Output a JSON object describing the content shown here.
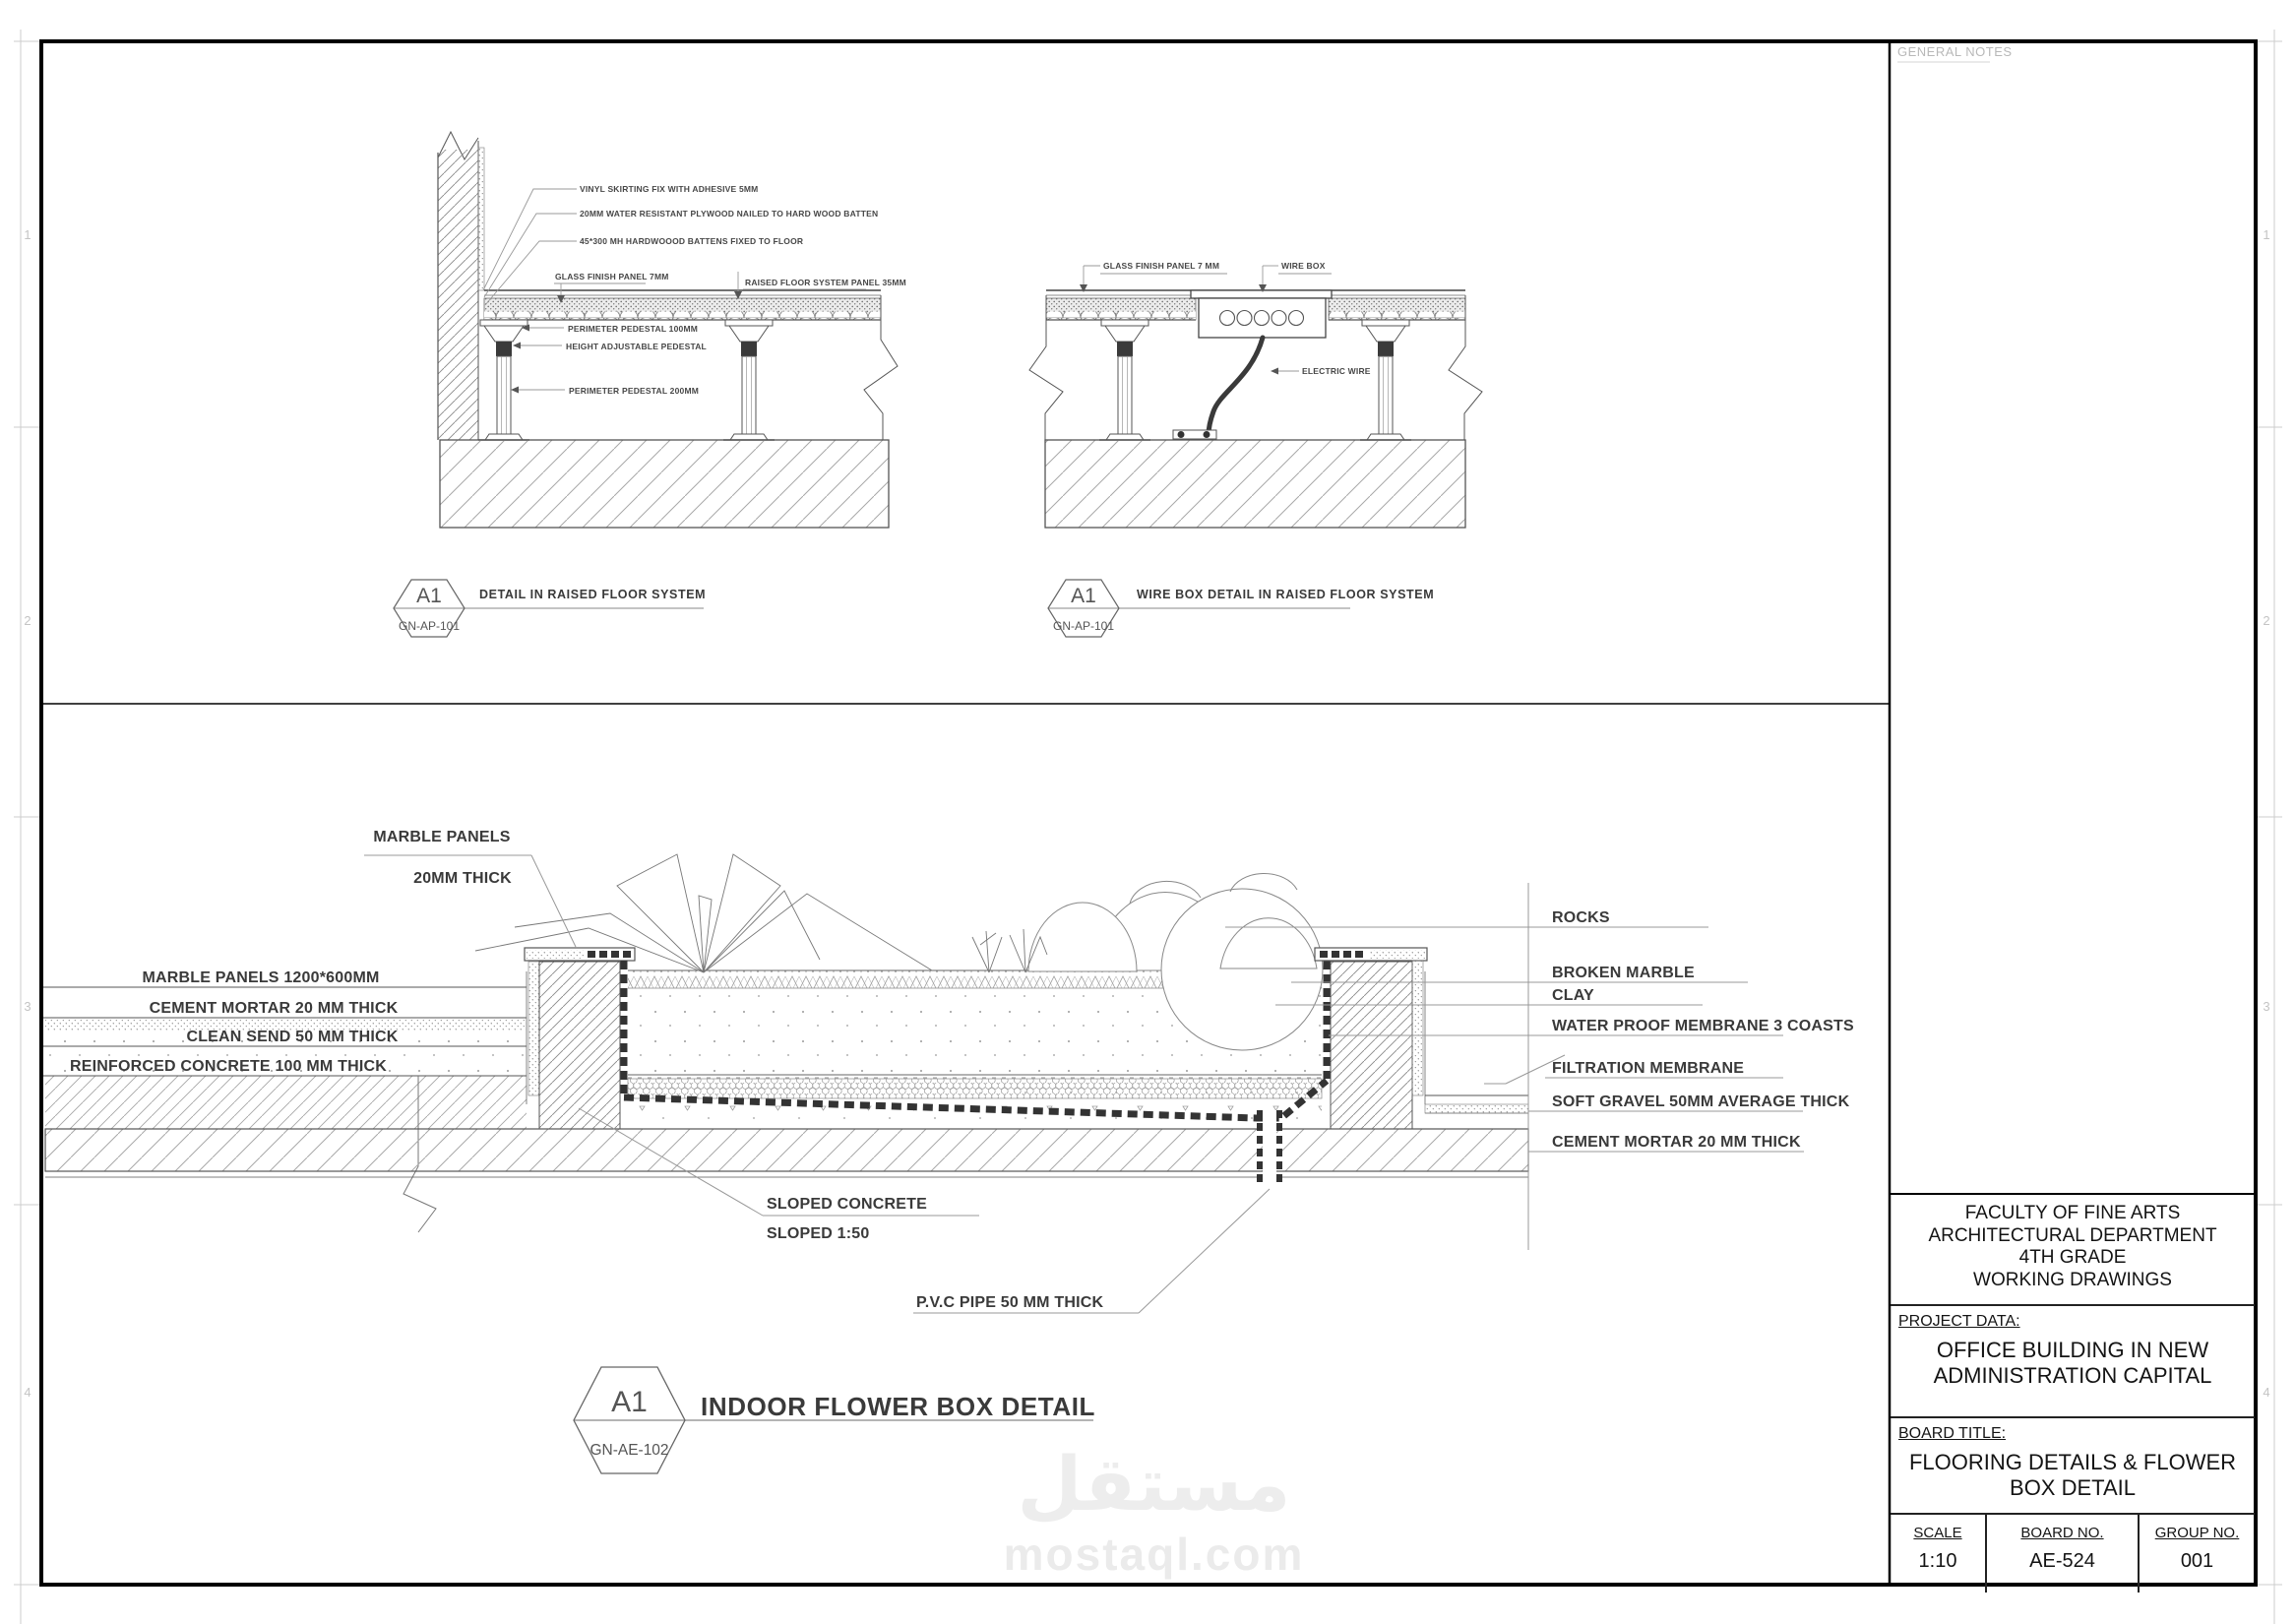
{
  "sheet": {
    "general_notes_label": "GENERAL NOTES",
    "zones": [
      "1",
      "2",
      "3",
      "4"
    ],
    "watermark": {
      "arabic": "مستقل",
      "latin": "mostaql.com"
    }
  },
  "title_block": {
    "institution": [
      "FACULTY OF FINE ARTS",
      "ARCHITECTURAL DEPARTMENT",
      "4TH GRADE",
      "WORKING DRAWINGS"
    ],
    "project_data_label": "PROJECT DATA:",
    "project_name": [
      "OFFICE BUILDING IN NEW",
      "ADMINISTRATION CAPITAL"
    ],
    "board_title_label": "BOARD TITLE:",
    "board_title": [
      "FLOORING DETAILS & FLOWER",
      "BOX DETAIL"
    ],
    "scale_label": "SCALE",
    "scale_value": "1:10",
    "board_no_label": "BOARD NO.",
    "board_no_value": "AE-524",
    "group_no_label": "GROUP NO.",
    "group_no_value": "001"
  },
  "detail_raised_floor": {
    "tag": "A1",
    "code": "GN-AP-101",
    "title": "DETAIL IN RAISED FLOOR SYSTEM",
    "labels": {
      "vinyl_skirting": "VINYL SKIRTING FIX WITH ADHESIVE 5MM",
      "plywood": "20MM WATER RESISTANT PLYWOOD NAILED TO HARD WOOD BATTEN",
      "battens": "45*300 MH HARDWOOOD BATTENS FIXED TO FLOOR",
      "glass_panel": "GLASS FINISH PANEL 7MM",
      "raised_panel": "RAISED FLOOR SYSTEM PANEL 35MM",
      "perimeter_pedestal_100": "PERIMETER PEDESTAL 100MM",
      "height_adjustable": "HEIGHT ADJUSTABLE PEDESTAL",
      "perimeter_pedestal_200": "PERIMETER PEDESTAL 200MM"
    }
  },
  "detail_wire_box": {
    "tag": "A1",
    "code": "GN-AP-101",
    "title": "WIRE BOX DETAIL IN RAISED FLOOR SYSTEM",
    "labels": {
      "glass_panel": "GLASS FINISH PANEL 7 MM",
      "wire_box": "WIRE BOX",
      "electric_wire": "ELECTRIC WIRE"
    }
  },
  "detail_flower_box": {
    "tag": "A1",
    "code": "GN-AE-102",
    "title": "INDOOR FLOWER BOX DETAIL",
    "labels": {
      "marble_panels": "MARBLE  PANELS",
      "marble_thick": "20MM THICK",
      "left_layers": [
        "MARBLE  PANELS 1200*600MM",
        "CEMENT MORTAR 20 MM THICK",
        "CLEAN SEND 50 MM THICK",
        "REINFORCED CONCRETE 100 MM THICK"
      ],
      "right_layers": [
        "ROCKS",
        "BROKEN MARBLE",
        "CLAY",
        "WATER PROOF MEMBRANE 3 COASTS",
        "FILTRATION MEMBRANE",
        "SOFT GRAVEL 50MM AVERAGE THICK",
        "CEMENT MORTAR 20 MM THICK"
      ],
      "sloped_concrete": "SLOPED CONCRETE",
      "sloped_ratio": "SLOPED 1:50",
      "pvc_pipe": "P.V.C PIPE 50 MM THICK"
    }
  }
}
